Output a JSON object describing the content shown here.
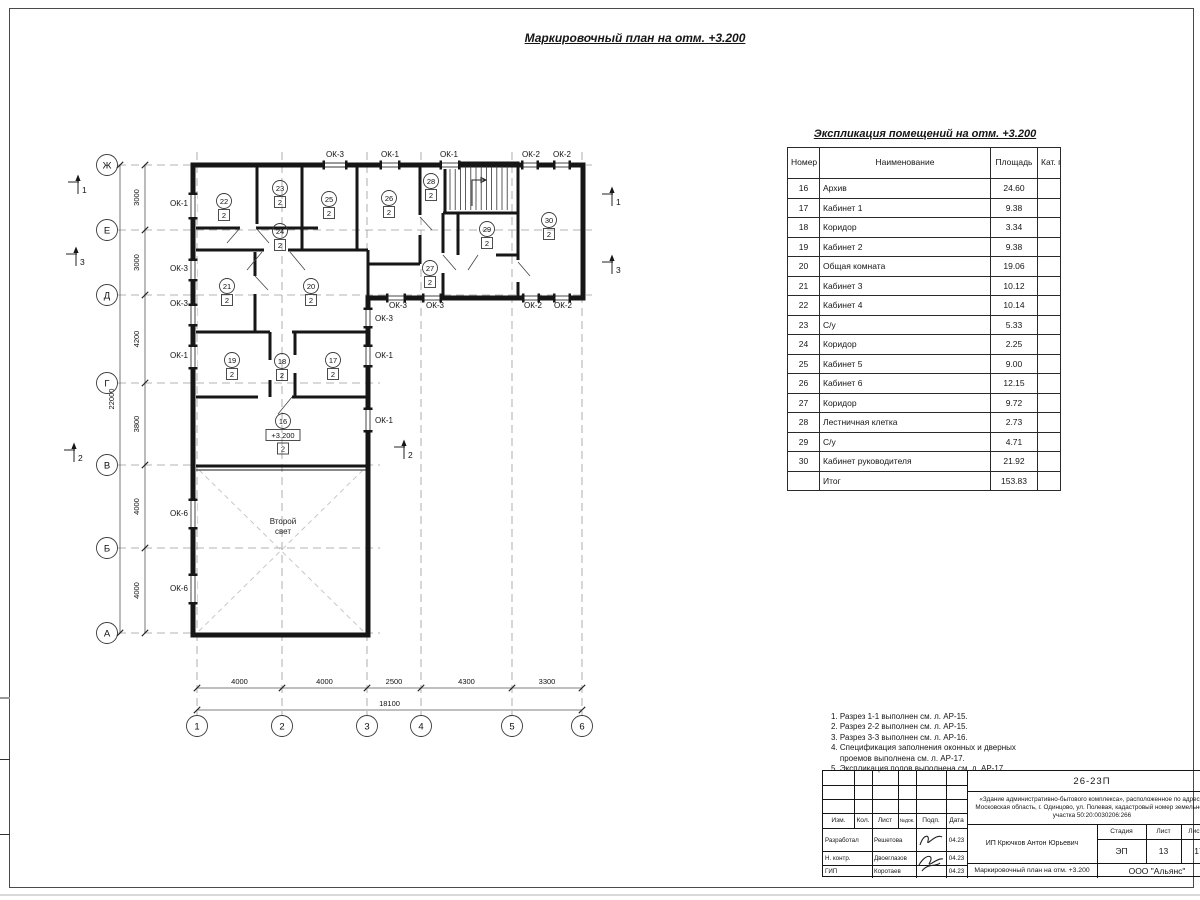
{
  "colors": {
    "ink": "#161616",
    "grid_line": "#9b9b9b",
    "paper": "#ffffff"
  },
  "sheet": {
    "main_title": "Маркировочный план на отм. +3.200"
  },
  "explication": {
    "title": "Экспликация помещений на отм. +3.200",
    "headers": {
      "num": "Номер помещ.",
      "name": "Наименование",
      "area": "Площадь",
      "cat": "Кат. пом."
    },
    "rows": [
      {
        "num": "16",
        "name": "Архив",
        "area": "24.60",
        "cat": ""
      },
      {
        "num": "17",
        "name": "Кабинет 1",
        "area": "9.38",
        "cat": ""
      },
      {
        "num": "18",
        "name": "Коридор",
        "area": "3.34",
        "cat": ""
      },
      {
        "num": "19",
        "name": "Кабинет 2",
        "area": "9.38",
        "cat": ""
      },
      {
        "num": "20",
        "name": "Общая комната",
        "area": "19.06",
        "cat": ""
      },
      {
        "num": "21",
        "name": "Кабинет 3",
        "area": "10.12",
        "cat": ""
      },
      {
        "num": "22",
        "name": "Кабинет 4",
        "area": "10.14",
        "cat": ""
      },
      {
        "num": "23",
        "name": "С/у",
        "area": "5.33",
        "cat": ""
      },
      {
        "num": "24",
        "name": "Коридор",
        "area": "2.25",
        "cat": ""
      },
      {
        "num": "25",
        "name": "Кабинет 5",
        "area": "9.00",
        "cat": ""
      },
      {
        "num": "26",
        "name": "Кабинет 6",
        "area": "12.15",
        "cat": ""
      },
      {
        "num": "27",
        "name": "Коридор",
        "area": "9.72",
        "cat": ""
      },
      {
        "num": "28",
        "name": "Лестничная клетка",
        "area": "2.73",
        "cat": ""
      },
      {
        "num": "29",
        "name": "С/у",
        "area": "4.71",
        "cat": ""
      },
      {
        "num": "30",
        "name": "Кабинет руководителя",
        "area": "21.92",
        "cat": ""
      },
      {
        "num": "",
        "name": "Итог",
        "area": "153.83",
        "cat": ""
      }
    ]
  },
  "notes": [
    "1. Разрез 1-1 выполнен см. л. АР-15.",
    "2. Разрез 2-2 выполнен см. л. АР-15.",
    "3. Разрез 3-3 выполнен см. л. АР-16.",
    "4. Спецификация заполнения оконных и дверных\n    проемов выполнена см. л. АР-17.",
    "5. Экспликация полов выполнена см. л. АР-17."
  ],
  "plan": {
    "axis_rows": [
      {
        "label": "Ж",
        "y": 165
      },
      {
        "label": "Е",
        "y": 230
      },
      {
        "label": "Д",
        "y": 295
      },
      {
        "label": "Г",
        "y": 383
      },
      {
        "label": "В",
        "y": 465
      },
      {
        "label": "Б",
        "y": 548
      },
      {
        "label": "А",
        "y": 633
      }
    ],
    "axis_cols": [
      {
        "label": "1",
        "x": 197
      },
      {
        "label": "2",
        "x": 282
      },
      {
        "label": "3",
        "x": 367
      },
      {
        "label": "4",
        "x": 421
      },
      {
        "label": "5",
        "x": 512
      },
      {
        "label": "6",
        "x": 582
      }
    ],
    "dims_left": [
      {
        "t": "3000",
        "y": 197.5
      },
      {
        "t": "3000",
        "y": 262.5
      },
      {
        "t": "4200",
        "y": 339
      },
      {
        "t": "3800",
        "y": 424
      },
      {
        "t": "4000",
        "y": 506.5
      },
      {
        "t": "4000",
        "y": 590.5
      }
    ],
    "dim_total_left": "22000",
    "dims_bottom": [
      {
        "t": "4000",
        "x": 239.5
      },
      {
        "t": "4000",
        "x": 324.5
      },
      {
        "t": "2500",
        "x": 394
      },
      {
        "t": "4300",
        "x": 466.5
      },
      {
        "t": "3300",
        "x": 547
      }
    ],
    "dim_total_bottom": "18100",
    "windows": [
      {
        "o": "h",
        "x": 335,
        "y": 165,
        "w": 20
      },
      {
        "o": "h",
        "x": 390,
        "y": 165,
        "w": 16
      },
      {
        "o": "h",
        "x": 450,
        "y": 165,
        "w": 16
      },
      {
        "o": "h",
        "x": 530,
        "y": 165,
        "w": 13
      },
      {
        "o": "h",
        "x": 562,
        "y": 165,
        "w": 13
      },
      {
        "o": "v",
        "x": 193,
        "y": 206,
        "w": 22
      },
      {
        "o": "v",
        "x": 193,
        "y": 270,
        "w": 18
      },
      {
        "o": "v",
        "x": 193,
        "y": 315,
        "w": 18
      },
      {
        "o": "v",
        "x": 193,
        "y": 357,
        "w": 20
      },
      {
        "o": "v",
        "x": 193,
        "y": 514,
        "w": 26
      },
      {
        "o": "v",
        "x": 193,
        "y": 589,
        "w": 26
      },
      {
        "o": "h",
        "x": 396,
        "y": 298,
        "w": 15
      },
      {
        "o": "h",
        "x": 432,
        "y": 298,
        "w": 15
      },
      {
        "o": "h",
        "x": 531,
        "y": 298,
        "w": 13
      },
      {
        "o": "h",
        "x": 562,
        "y": 298,
        "w": 13
      },
      {
        "o": "v",
        "x": 368,
        "y": 318,
        "w": 16
      },
      {
        "o": "v",
        "x": 368,
        "y": 356,
        "w": 18
      },
      {
        "o": "v",
        "x": 368,
        "y": 420,
        "w": 20
      }
    ],
    "window_labels": [
      {
        "text": "ОК-3",
        "x": 335,
        "y": 157,
        "a": "middle"
      },
      {
        "text": "ОК-1",
        "x": 390,
        "y": 157,
        "a": "middle"
      },
      {
        "text": "ОК-1",
        "x": 449,
        "y": 157,
        "a": "middle"
      },
      {
        "text": "ОК-2",
        "x": 531,
        "y": 157,
        "a": "middle"
      },
      {
        "text": "ОК-2",
        "x": 562,
        "y": 157,
        "a": "middle"
      },
      {
        "text": "ОК-1",
        "x": 188,
        "y": 206,
        "a": "end"
      },
      {
        "text": "ОК-3",
        "x": 188,
        "y": 271,
        "a": "end"
      },
      {
        "text": "ОК-3",
        "x": 188,
        "y": 306,
        "a": "end"
      },
      {
        "text": "ОК-1",
        "x": 188,
        "y": 358,
        "a": "end"
      },
      {
        "text": "ОК-6",
        "x": 188,
        "y": 516,
        "a": "end"
      },
      {
        "text": "ОК-6",
        "x": 188,
        "y": 591,
        "a": "end"
      },
      {
        "text": "ОК-3",
        "x": 398,
        "y": 308,
        "a": "middle"
      },
      {
        "text": "ОК-3",
        "x": 435,
        "y": 308,
        "a": "middle"
      },
      {
        "text": "ОК-2",
        "x": 533,
        "y": 308,
        "a": "middle"
      },
      {
        "text": "ОК-2",
        "x": 563,
        "y": 308,
        "a": "middle"
      },
      {
        "text": "ОК-3",
        "x": 375,
        "y": 321,
        "a": "start"
      },
      {
        "text": "ОК-1",
        "x": 375,
        "y": 358,
        "a": "start"
      },
      {
        "text": "ОК-1",
        "x": 375,
        "y": 423,
        "a": "start"
      }
    ],
    "rooms": [
      {
        "n": "22",
        "x": 224,
        "y": 201,
        "cat": "2"
      },
      {
        "n": "23",
        "x": 280,
        "y": 188,
        "cat": "2"
      },
      {
        "n": "25",
        "x": 329,
        "y": 199,
        "cat": "2"
      },
      {
        "n": "26",
        "x": 389,
        "y": 198,
        "cat": "2"
      },
      {
        "n": "28",
        "x": 431,
        "y": 181,
        "cat": "2"
      },
      {
        "n": "24",
        "x": 280,
        "y": 231,
        "cat": "2"
      },
      {
        "n": "29",
        "x": 487,
        "y": 229,
        "cat": "2"
      },
      {
        "n": "30",
        "x": 549,
        "y": 220,
        "cat": "2"
      },
      {
        "n": "21",
        "x": 227,
        "y": 286,
        "cat": "2"
      },
      {
        "n": "20",
        "x": 311,
        "y": 286,
        "cat": "2"
      },
      {
        "n": "27",
        "x": 430,
        "y": 268,
        "cat": "2"
      },
      {
        "n": "19",
        "x": 232,
        "y": 360,
        "cat": "2"
      },
      {
        "n": "18",
        "x": 282,
        "y": 361,
        "cat": "2"
      },
      {
        "n": "17",
        "x": 333,
        "y": 360,
        "cat": "2"
      },
      {
        "n": "16",
        "x": 283,
        "y": 421,
        "cat": "2",
        "elev": "+3.200"
      }
    ],
    "section_markers": [
      {
        "n": "1",
        "x": 78,
        "y": 190
      },
      {
        "n": "3",
        "x": 76,
        "y": 262
      },
      {
        "n": "2",
        "x": 74,
        "y": 458
      },
      {
        "n": "1",
        "x": 612,
        "y": 202
      },
      {
        "n": "3",
        "x": 612,
        "y": 270
      },
      {
        "n": "2",
        "x": 404,
        "y": 455
      }
    ],
    "void_label": "Второй\nсвет"
  },
  "stamp": {
    "doc_code": "26-23П",
    "description": "«Здание административно-бытового комплекса», расположенное по адресу: Московская область, г. Одинцово, ул. Полевая, кадастровый номер земельного участка 50:20:0030206:266",
    "header_cols": [
      "Изм.",
      "Кол.",
      "Лист",
      "№док.",
      "Подп.",
      "Дата"
    ],
    "sig_rows": [
      {
        "role": "Разработал",
        "name": "Решетова",
        "date": "04.23"
      },
      {
        "role": "Н. контр.",
        "name": "Двоеглазов",
        "date": "04.23"
      },
      {
        "role": "ГИП",
        "name": "Коротаев",
        "date": "04.23"
      }
    ],
    "client": "ИП Крючков Антон Юрьевич",
    "stage_label": "Стадия",
    "sheet_label": "Лист",
    "sheets_label": "Листов",
    "stage": "ЭП",
    "sheet": "13",
    "sheets": "17",
    "doc_title": "Маркировочный план на отм. +3.200",
    "org": "ООО \"Альянс\""
  }
}
